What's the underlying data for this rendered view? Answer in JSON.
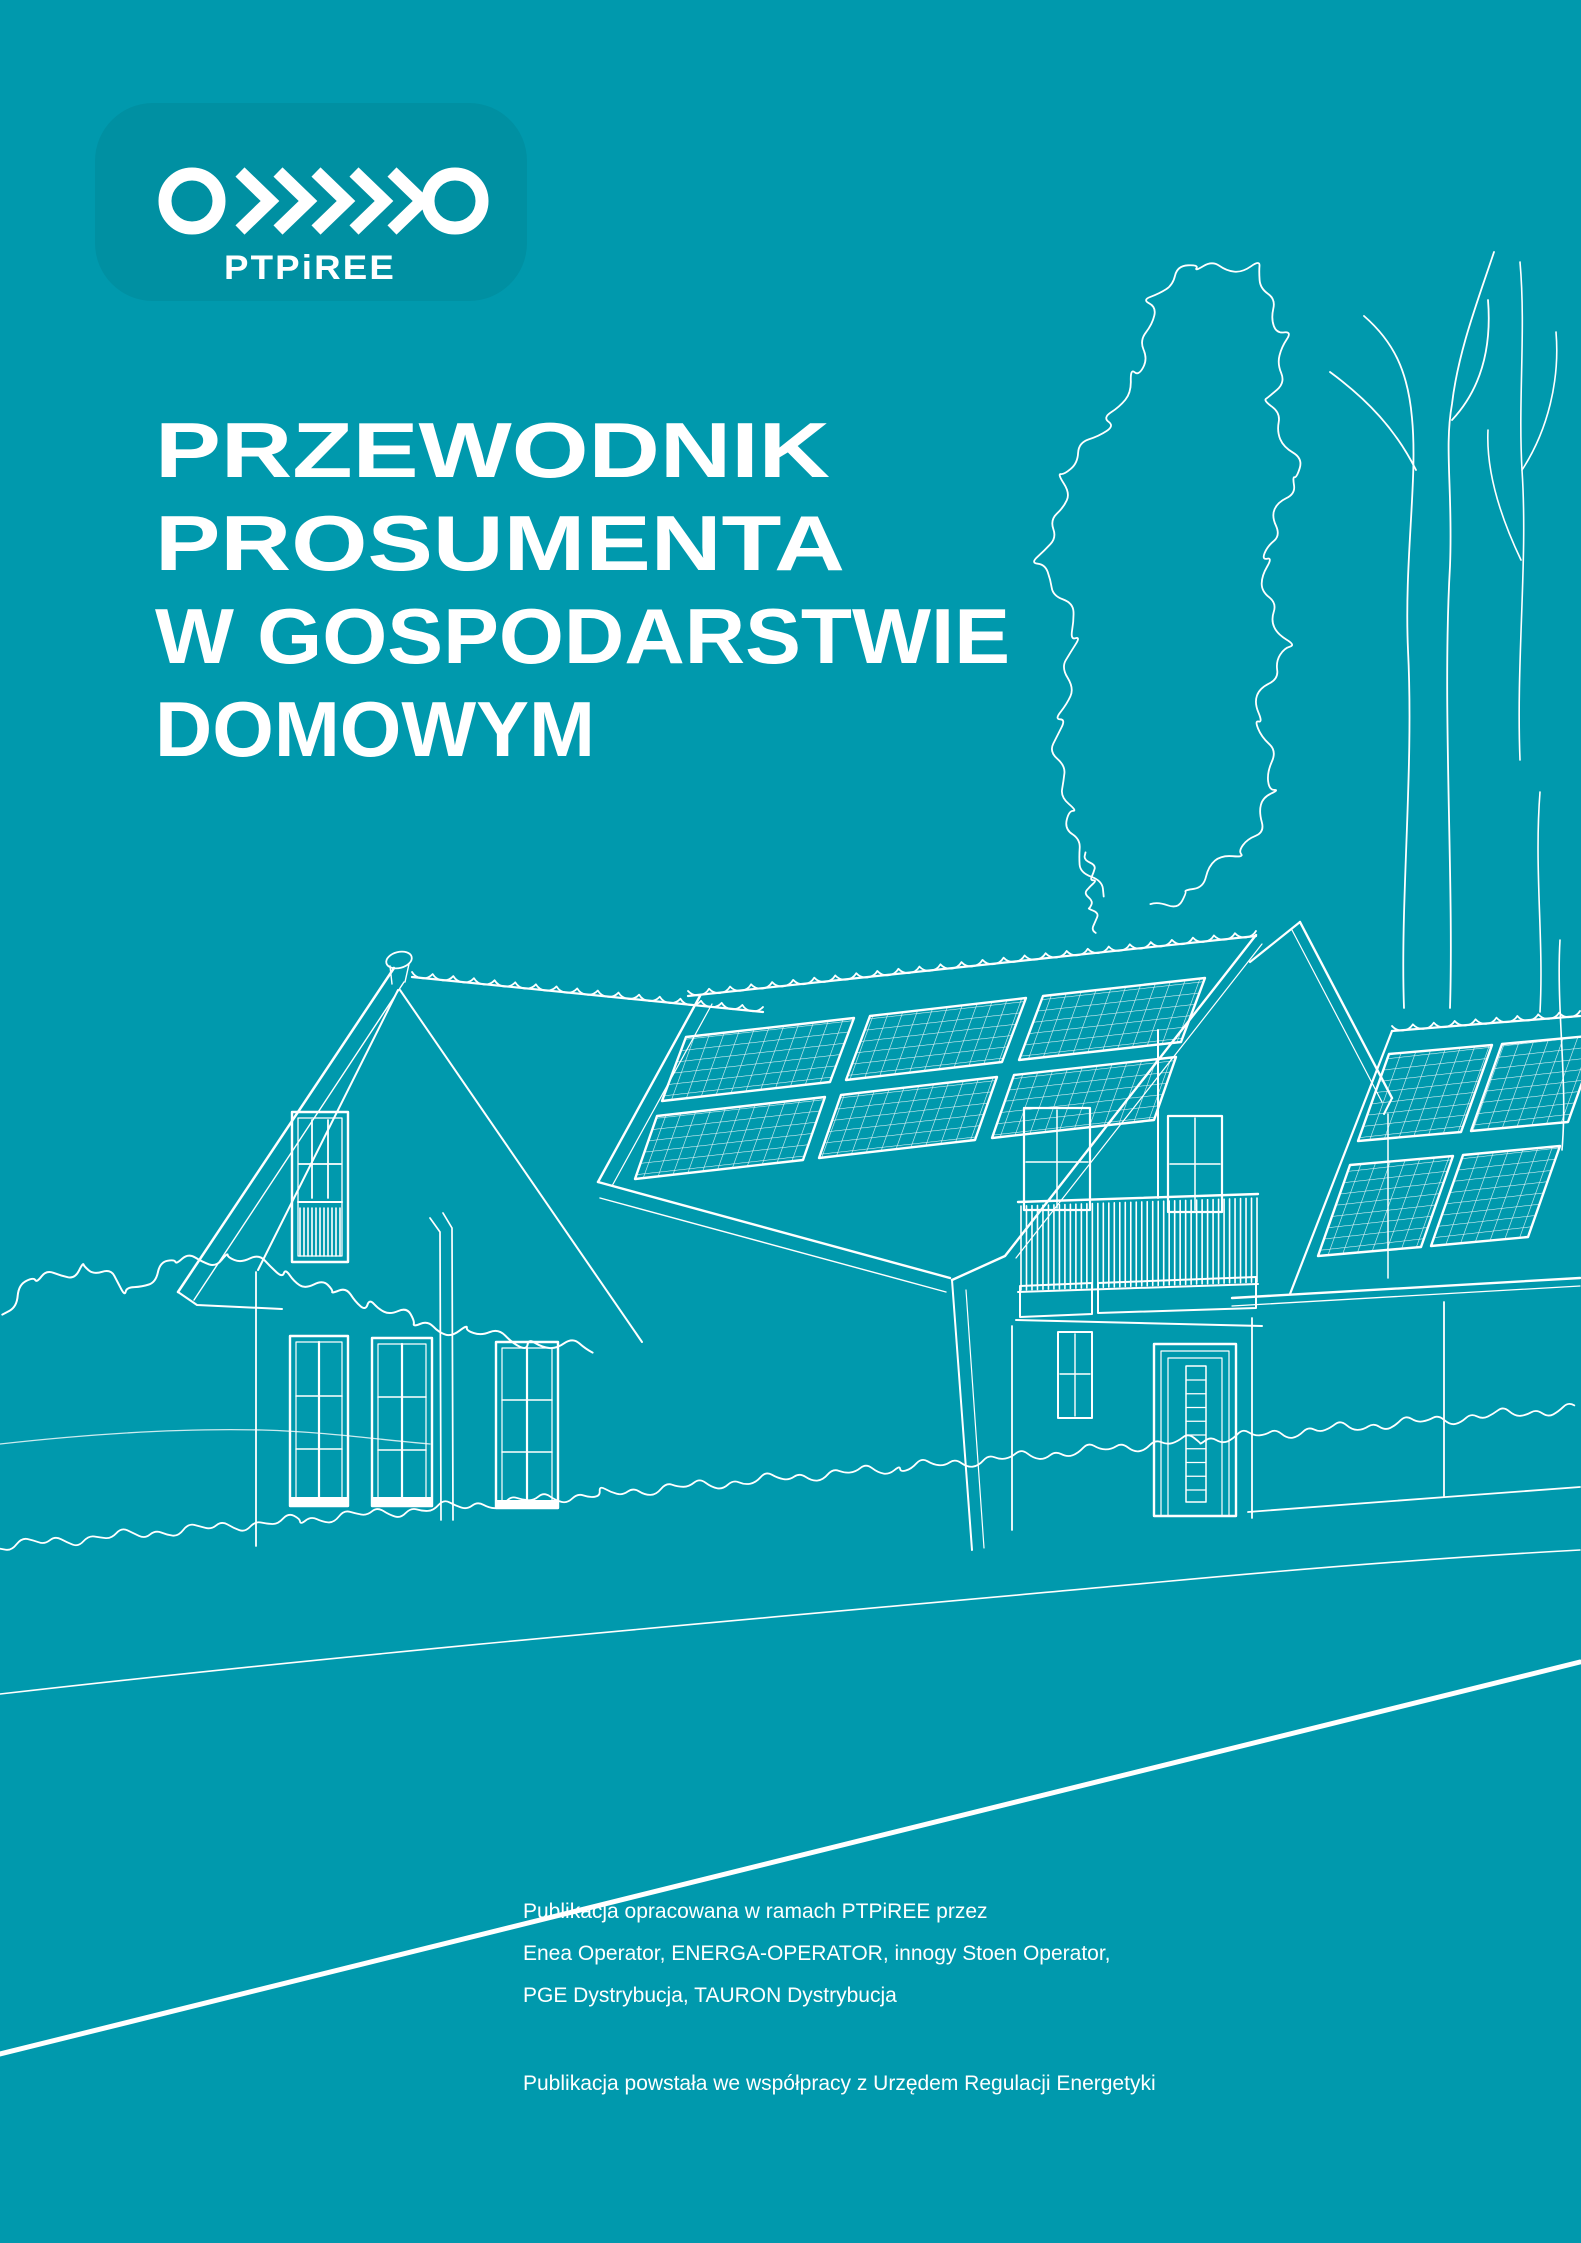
{
  "cover": {
    "colors": {
      "background": "#0099ad",
      "logo_panel": "#0090a2",
      "line": "#ffffff",
      "text": "#ffffff"
    },
    "logo": {
      "wordmark": "PTPiREE",
      "icon": "circle-chevrons-circle-icon"
    },
    "title": {
      "lines": [
        "PRZEWODNIK",
        "PROSUMENTA",
        "W GOSPODARSTWIE",
        "DOMOWYM"
      ]
    },
    "illustration": {
      "icons": [
        "family-house-with-solar-panels-icon",
        "left-gable-attic-balcony-icon",
        "rooftop-solar-array-icon",
        "garage-solar-array-icon",
        "balcony-railing-icon",
        "front-door-icon",
        "deciduous-tree-icon",
        "bare-tree-icon",
        "bushes-icon",
        "lawn-scribble-icon",
        "road-edge-icon"
      ]
    },
    "footer": {
      "credits_lines": [
        "Publikacja opracowana w ramach PTPiREE przez",
        "Enea Operator, ENERGA-OPERATOR, innogy Stoen Operator,",
        "PGE Dystrybucja, TAURON Dystrybucja"
      ],
      "cooperation_line": "Publikacja powstała we współpracy z Urzędem Regulacji Energetyki"
    }
  }
}
